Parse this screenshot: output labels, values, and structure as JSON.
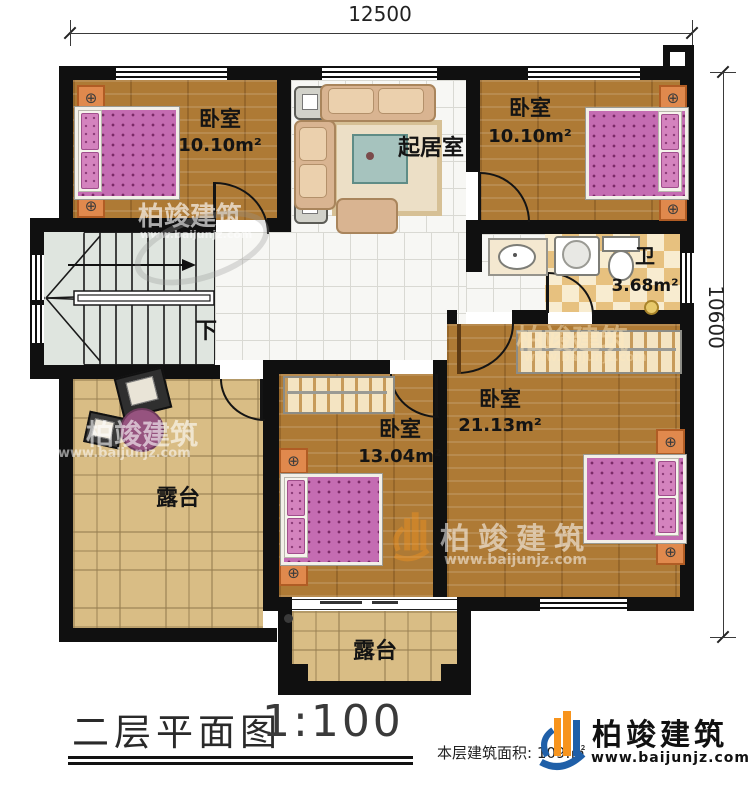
{
  "dimensions": {
    "width_top": "12500",
    "height_right": "10600"
  },
  "rooms": {
    "bedroom_top_left": {
      "name": "卧室",
      "area": "10.10m²"
    },
    "bedroom_top_right": {
      "name": "卧室",
      "area": "10.10m²"
    },
    "living_room": {
      "name": "起居室"
    },
    "bathroom": {
      "name": "卫",
      "area": "3.68m²"
    },
    "bedroom_middle": {
      "name": "卧室",
      "area": "13.04m²"
    },
    "bedroom_master": {
      "name": "卧室",
      "area": "21.13m²"
    },
    "terrace_left": {
      "name": "露台"
    },
    "terrace_bottom": {
      "name": "露台"
    },
    "stairs": {
      "direction_label": "下"
    }
  },
  "title_block": {
    "caption": "二层平面图",
    "scale": "1:100",
    "floor_area_label": "本层建筑面积:",
    "floor_area_value": "109.",
    "floor_area_unit": "㎡"
  },
  "branding": {
    "company": "柏竣建筑",
    "website": "www.baijunjz.com"
  },
  "colors": {
    "wall": "#101010",
    "wood": "#ae7a35",
    "checker_dark": "#e7c17f",
    "terrace": "#d9bd85",
    "logo_orange": "#f7941d",
    "logo_blue": "#1f5fa8"
  }
}
